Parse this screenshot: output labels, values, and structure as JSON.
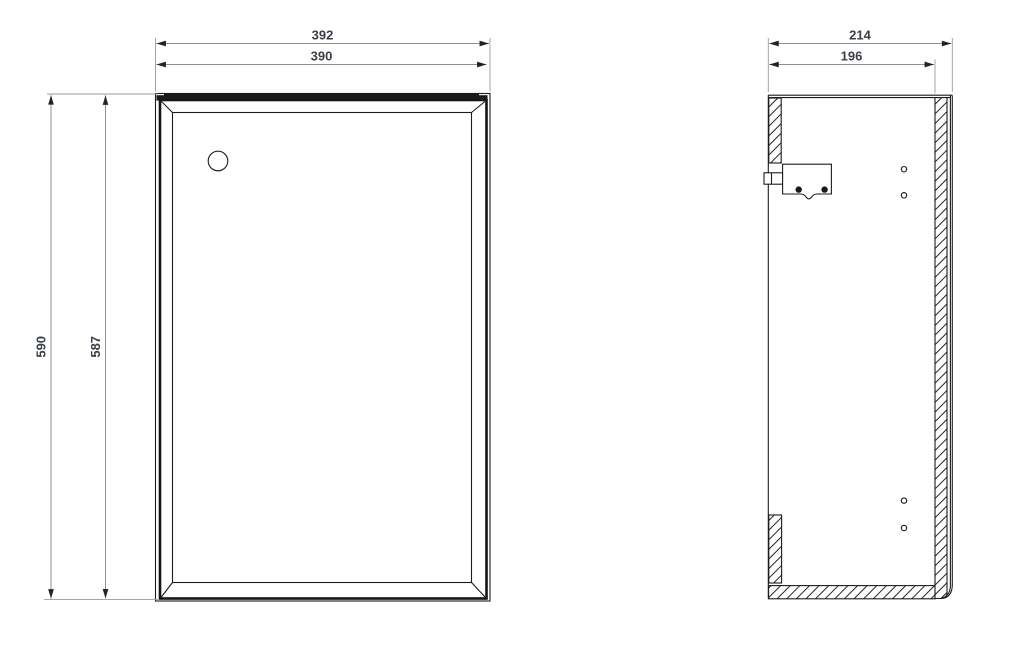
{
  "canvas": {
    "width": 1024,
    "height": 653,
    "background": "#ffffff"
  },
  "front_view": {
    "width_outer_mm": "392",
    "width_inner_mm": "390",
    "height_outer_mm": "590",
    "height_inner_mm": "587"
  },
  "side_view": {
    "depth_outer_mm": "214",
    "depth_inner_mm": "196"
  },
  "style": {
    "drawing_line_color": "#1c1c1c",
    "dimension_line_color": "#8f8f8f",
    "dimension_text_color": "#3b4048",
    "hatch_color": "#242424"
  }
}
